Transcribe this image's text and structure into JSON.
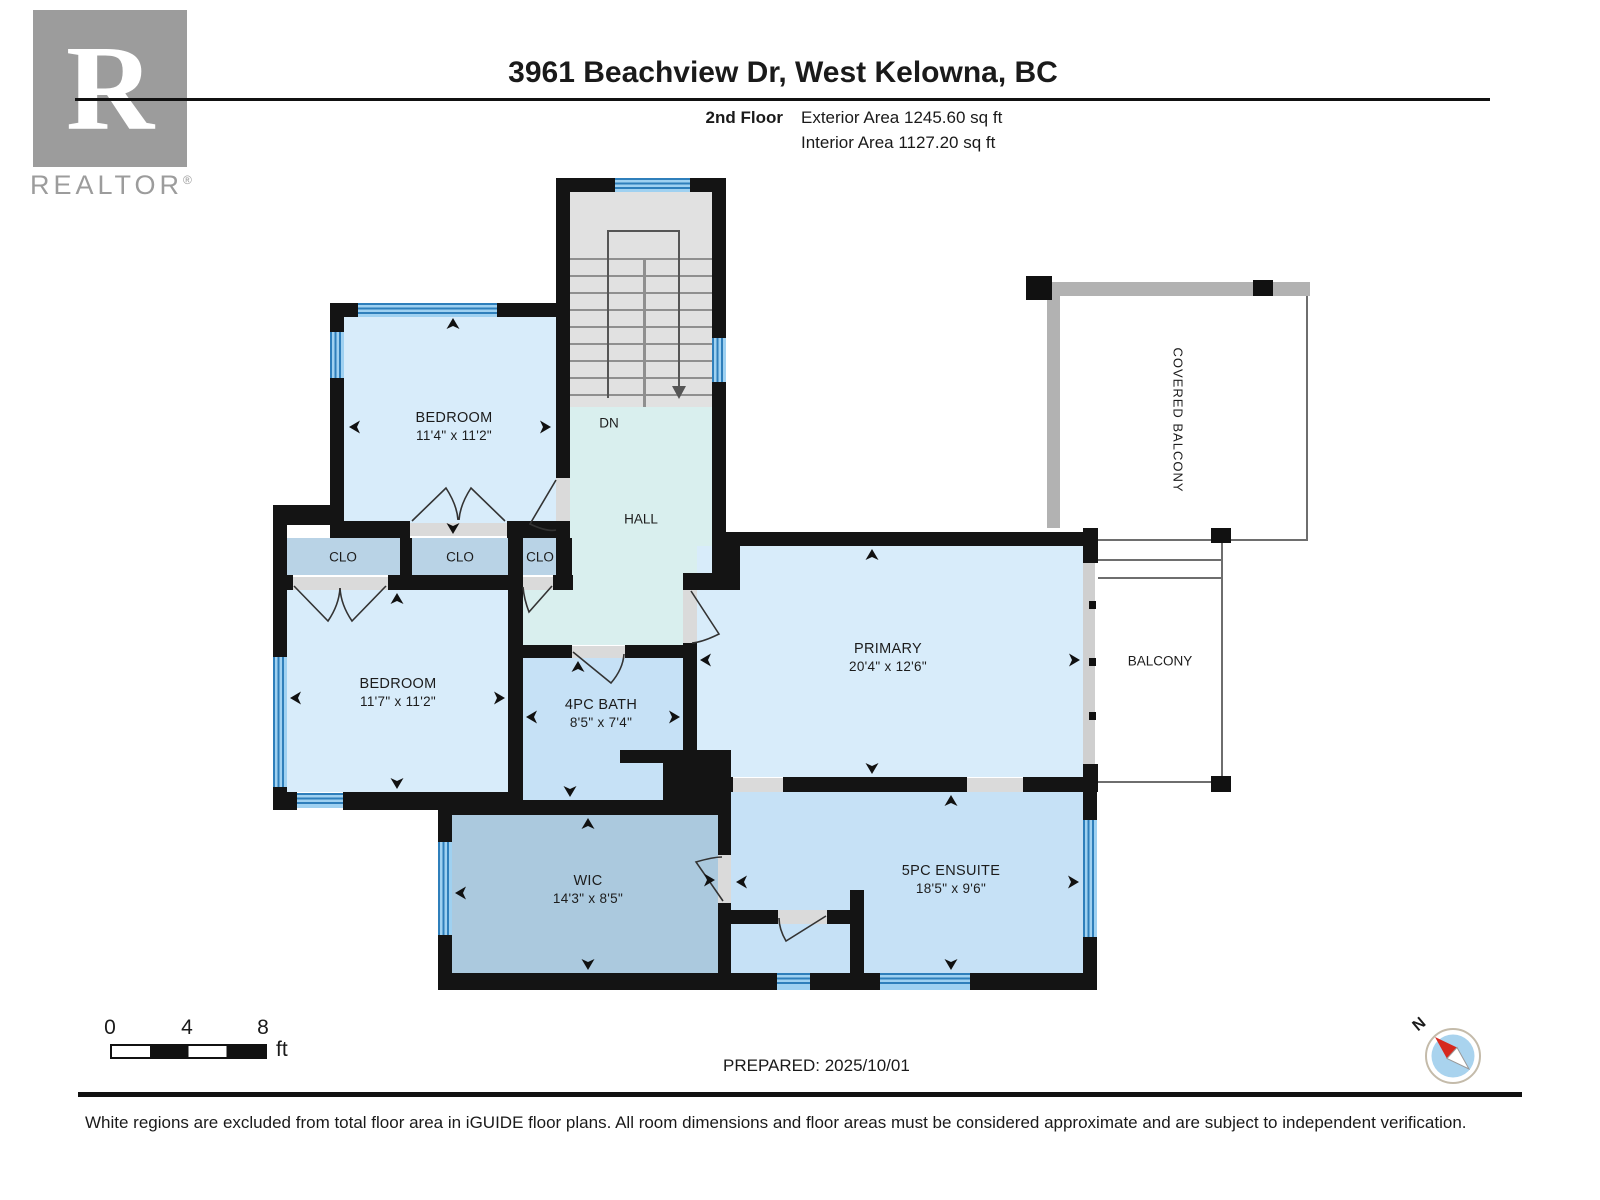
{
  "header": {
    "title": "3961 Beachview Dr, West Kelowna, BC",
    "floor_label": "2nd Floor",
    "exterior_area": "Exterior Area 1245.60 sq ft",
    "interior_area": "Interior Area 1127.20 sq ft"
  },
  "logo": {
    "letter": "R",
    "brand": "REALTOR",
    "registered": "®"
  },
  "plan": {
    "rooms": {
      "bedroom_top": {
        "name": "BEDROOM",
        "dims": "11'4\" x 11'2\""
      },
      "bedroom_left": {
        "name": "BEDROOM",
        "dims": "11'7\" x 11'2\""
      },
      "bath": {
        "name": "4PC BATH",
        "dims": "8'5\" x 7'4\""
      },
      "primary": {
        "name": "PRIMARY",
        "dims": "20'4\" x 12'6\""
      },
      "wic": {
        "name": "WIC",
        "dims": "14'3\" x 8'5\""
      },
      "ensuite": {
        "name": "5PC ENSUITE",
        "dims": "18'5\" x 9'6\""
      },
      "hall": {
        "name": "HALL"
      },
      "closet1": {
        "name": "CLO"
      },
      "closet2": {
        "name": "CLO"
      },
      "closet3": {
        "name": "CLO"
      },
      "balcony": {
        "name": "BALCONY"
      },
      "covered_balcony": {
        "name": "COVERED BALCONY"
      },
      "stairs": {
        "direction_label": "DN"
      }
    }
  },
  "scale_bar": {
    "tick_0": "0",
    "tick_4": "4",
    "tick_8": "8",
    "unit": "ft"
  },
  "prepared_label": "PREPARED: 2025/10/01",
  "compass": {
    "north_label": "N"
  },
  "footer": {
    "disclaimer": "White regions are excluded from total floor area in iGUIDE floor plans. All room dimensions and floor areas must be considered approximate and are subject to independent verification."
  },
  "colors": {
    "wall": "#141414",
    "window_stripe": "#2f7fbb",
    "window_fill": "#9fd1f1",
    "room_blue": "#d8ecfa",
    "bath_blue": "#c6e1f6",
    "hall_teal": "#d9efee",
    "closet_blue": "#b9d3e6",
    "wic_blue": "#abc9de",
    "stair_gray": "#e1e1e1",
    "balcony_wall_gray": "#b2b2b2",
    "compass_red": "#d6281e",
    "compass_inner": "#a9d3ee"
  }
}
